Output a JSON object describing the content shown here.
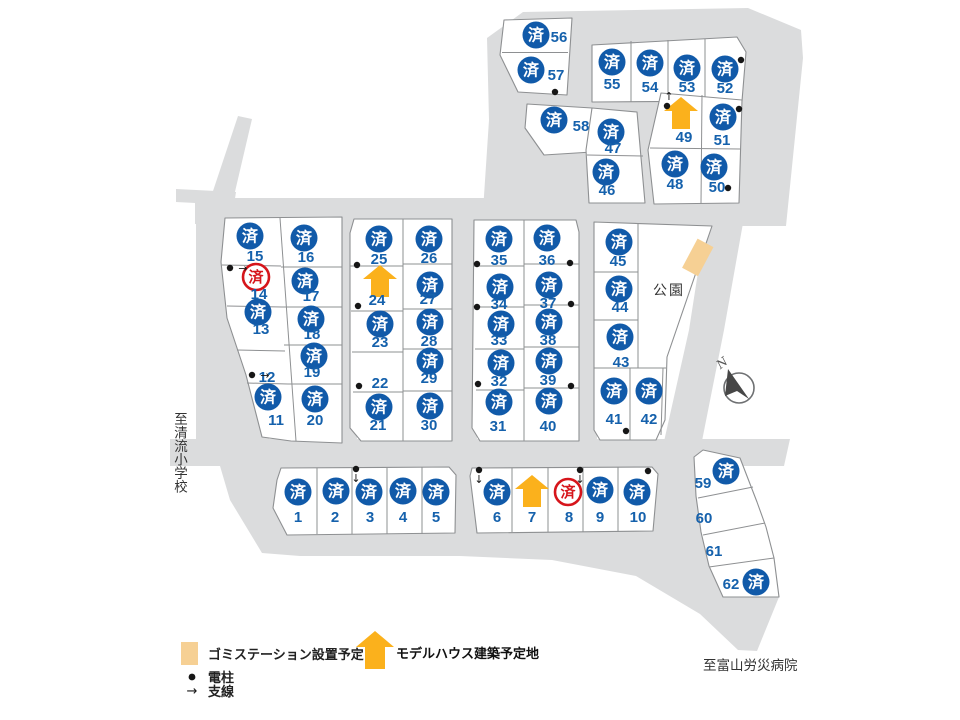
{
  "labels": {
    "park": "公園",
    "to_school": "至清流小学校",
    "to_hospital": "至富山労災病院",
    "north": "N",
    "sold_mark": "済"
  },
  "legend": {
    "gomi_label": "ゴミステーション設置予定",
    "model_house_label": "モデルハウス建築予定地",
    "pole_label": "電柱",
    "wire_label": "支線"
  },
  "colors": {
    "sold_blue": "#115aa9",
    "number_blue": "#1561ac",
    "sold_red": "#d6151b",
    "house_yellow": "#fbb11c",
    "gomi_tan": "#f6d094",
    "road_gray": "#dbdcdd",
    "lot_stroke": "#8e9092"
  },
  "lots": [
    {
      "no": 1,
      "status": "sold",
      "b": [
        298,
        492
      ],
      "t": [
        298,
        517
      ]
    },
    {
      "no": 2,
      "status": "sold",
      "b": [
        336,
        491
      ],
      "t": [
        335,
        517
      ]
    },
    {
      "no": 3,
      "status": "sold",
      "b": [
        369,
        492
      ],
      "t": [
        370,
        517
      ]
    },
    {
      "no": 4,
      "status": "sold",
      "b": [
        403,
        491
      ],
      "t": [
        403,
        517
      ]
    },
    {
      "no": 5,
      "status": "sold",
      "b": [
        436,
        492
      ],
      "t": [
        436,
        517
      ]
    },
    {
      "no": 6,
      "status": "sold",
      "b": [
        497,
        492
      ],
      "t": [
        497,
        517
      ]
    },
    {
      "no": 7,
      "status": "model_house",
      "h": [
        532,
        492
      ],
      "t": [
        532,
        517
      ]
    },
    {
      "no": 8,
      "status": "sold_red",
      "b": [
        568,
        492
      ],
      "t": [
        569,
        517
      ]
    },
    {
      "no": 9,
      "status": "sold",
      "b": [
        600,
        490
      ],
      "t": [
        600,
        517
      ]
    },
    {
      "no": 10,
      "status": "sold",
      "b": [
        637,
        492
      ],
      "t": [
        638,
        517
      ]
    },
    {
      "no": 11,
      "status": "sold",
      "b": [
        268,
        397
      ],
      "t": [
        276,
        420
      ]
    },
    {
      "no": 12,
      "status": "open",
      "t": [
        267,
        377
      ]
    },
    {
      "no": 13,
      "status": "sold",
      "b": [
        258,
        312
      ],
      "t": [
        261,
        329
      ]
    },
    {
      "no": 14,
      "status": "sold_red",
      "b": [
        256,
        277
      ],
      "t": [
        259,
        294
      ]
    },
    {
      "no": 15,
      "status": "sold",
      "b": [
        250,
        236
      ],
      "t": [
        255,
        256
      ]
    },
    {
      "no": 16,
      "status": "sold",
      "b": [
        304,
        238
      ],
      "t": [
        306,
        257
      ]
    },
    {
      "no": 17,
      "status": "sold",
      "b": [
        305,
        281
      ],
      "t": [
        311,
        296
      ]
    },
    {
      "no": 18,
      "status": "sold",
      "b": [
        311,
        319
      ],
      "t": [
        312,
        334
      ]
    },
    {
      "no": 19,
      "status": "sold",
      "b": [
        314,
        356
      ],
      "t": [
        312,
        372
      ]
    },
    {
      "no": 20,
      "status": "sold",
      "b": [
        315,
        399
      ],
      "t": [
        315,
        420
      ]
    },
    {
      "no": 21,
      "status": "sold",
      "b": [
        379,
        407
      ],
      "t": [
        378,
        425
      ]
    },
    {
      "no": 22,
      "status": "open",
      "t": [
        380,
        383
      ]
    },
    {
      "no": 23,
      "status": "sold",
      "b": [
        380,
        324
      ],
      "t": [
        380,
        342
      ]
    },
    {
      "no": 24,
      "status": "model_house",
      "h": [
        380,
        282
      ],
      "t": [
        377,
        300
      ]
    },
    {
      "no": 25,
      "status": "sold",
      "b": [
        379,
        239
      ],
      "t": [
        379,
        259
      ]
    },
    {
      "no": 26,
      "status": "sold",
      "b": [
        429,
        239
      ],
      "t": [
        429,
        258
      ]
    },
    {
      "no": 27,
      "status": "sold",
      "b": [
        430,
        285
      ],
      "t": [
        428,
        299
      ]
    },
    {
      "no": 28,
      "status": "sold",
      "b": [
        430,
        322
      ],
      "t": [
        429,
        341
      ]
    },
    {
      "no": 29,
      "status": "sold",
      "b": [
        430,
        361
      ],
      "t": [
        429,
        378
      ]
    },
    {
      "no": 30,
      "status": "sold",
      "b": [
        430,
        406
      ],
      "t": [
        429,
        425
      ]
    },
    {
      "no": 31,
      "status": "sold",
      "b": [
        499,
        402
      ],
      "t": [
        498,
        426
      ]
    },
    {
      "no": 32,
      "status": "sold",
      "b": [
        501,
        363
      ],
      "t": [
        499,
        381
      ]
    },
    {
      "no": 33,
      "status": "sold",
      "b": [
        501,
        324
      ],
      "t": [
        499,
        340
      ]
    },
    {
      "no": 34,
      "status": "sold",
      "b": [
        500,
        287
      ],
      "t": [
        499,
        304
      ]
    },
    {
      "no": 35,
      "status": "sold",
      "b": [
        499,
        239
      ],
      "t": [
        499,
        260
      ]
    },
    {
      "no": 36,
      "status": "sold",
      "b": [
        547,
        238
      ],
      "t": [
        547,
        260
      ]
    },
    {
      "no": 37,
      "status": "sold",
      "b": [
        549,
        285
      ],
      "t": [
        548,
        303
      ]
    },
    {
      "no": 38,
      "status": "sold",
      "b": [
        549,
        322
      ],
      "t": [
        548,
        340
      ]
    },
    {
      "no": 39,
      "status": "sold",
      "b": [
        549,
        361
      ],
      "t": [
        548,
        380
      ]
    },
    {
      "no": 40,
      "status": "sold",
      "b": [
        549,
        401
      ],
      "t": [
        548,
        426
      ]
    },
    {
      "no": 41,
      "status": "sold",
      "b": [
        614,
        391
      ],
      "t": [
        614,
        419
      ]
    },
    {
      "no": 42,
      "status": "sold",
      "b": [
        649,
        391
      ],
      "t": [
        649,
        419
      ]
    },
    {
      "no": 43,
      "status": "sold",
      "b": [
        620,
        337
      ],
      "t": [
        621,
        362
      ]
    },
    {
      "no": 44,
      "status": "sold",
      "b": [
        619,
        289
      ],
      "t": [
        620,
        307
      ]
    },
    {
      "no": 45,
      "status": "sold",
      "b": [
        619,
        242
      ],
      "t": [
        618,
        261
      ]
    },
    {
      "no": 46,
      "status": "sold",
      "b": [
        606,
        172
      ],
      "t": [
        607,
        190
      ]
    },
    {
      "no": 47,
      "status": "sold",
      "b": [
        611,
        132
      ],
      "t": [
        613,
        148
      ]
    },
    {
      "no": 48,
      "status": "sold",
      "b": [
        675,
        164
      ],
      "t": [
        675,
        184
      ]
    },
    {
      "no": 49,
      "status": "model_house",
      "h": [
        681,
        114
      ],
      "t": [
        684,
        137
      ]
    },
    {
      "no": 50,
      "status": "sold",
      "b": [
        714,
        167
      ],
      "t": [
        717,
        187
      ]
    },
    {
      "no": 51,
      "status": "sold",
      "b": [
        723,
        117
      ],
      "t": [
        722,
        140
      ]
    },
    {
      "no": 52,
      "status": "sold",
      "b": [
        725,
        69
      ],
      "t": [
        725,
        88
      ]
    },
    {
      "no": 53,
      "status": "sold",
      "b": [
        687,
        68
      ],
      "t": [
        687,
        87
      ]
    },
    {
      "no": 54,
      "status": "sold",
      "b": [
        650,
        63
      ],
      "t": [
        650,
        87
      ]
    },
    {
      "no": 55,
      "status": "sold",
      "b": [
        612,
        62
      ],
      "t": [
        612,
        84
      ]
    },
    {
      "no": 56,
      "status": "sold",
      "b": [
        536,
        35
      ],
      "t": [
        559,
        37
      ]
    },
    {
      "no": 57,
      "status": "sold",
      "b": [
        531,
        70
      ],
      "t": [
        556,
        75
      ]
    },
    {
      "no": 58,
      "status": "sold",
      "b": [
        554,
        120
      ],
      "t": [
        581,
        126
      ]
    },
    {
      "no": 59,
      "status": "sold",
      "b": [
        726,
        471
      ],
      "t": [
        703,
        483
      ]
    },
    {
      "no": 60,
      "status": "open",
      "t": [
        704,
        518
      ]
    },
    {
      "no": 61,
      "status": "open",
      "t": [
        714,
        551
      ]
    },
    {
      "no": 62,
      "status": "sold",
      "b": [
        756,
        582
      ],
      "t": [
        731,
        584
      ]
    }
  ],
  "poles": [
    {
      "x": 555,
      "y": 92
    },
    {
      "x": 741,
      "y": 60
    },
    {
      "x": 739,
      "y": 109
    },
    {
      "x": 728,
      "y": 188
    },
    {
      "x": 667,
      "y": 106,
      "dir": "up"
    },
    {
      "x": 230,
      "y": 268,
      "dir": "right"
    },
    {
      "x": 252,
      "y": 375,
      "dir": "right"
    },
    {
      "x": 357,
      "y": 265
    },
    {
      "x": 358,
      "y": 306
    },
    {
      "x": 359,
      "y": 386
    },
    {
      "x": 477,
      "y": 264
    },
    {
      "x": 477,
      "y": 307
    },
    {
      "x": 478,
      "y": 384
    },
    {
      "x": 570,
      "y": 263
    },
    {
      "x": 571,
      "y": 304
    },
    {
      "x": 571,
      "y": 386
    },
    {
      "x": 626,
      "y": 431
    },
    {
      "x": 356,
      "y": 469,
      "dir": "down"
    },
    {
      "x": 479,
      "y": 470,
      "dir": "down"
    },
    {
      "x": 580,
      "y": 470,
      "dir": "down"
    },
    {
      "x": 648,
      "y": 471
    }
  ]
}
